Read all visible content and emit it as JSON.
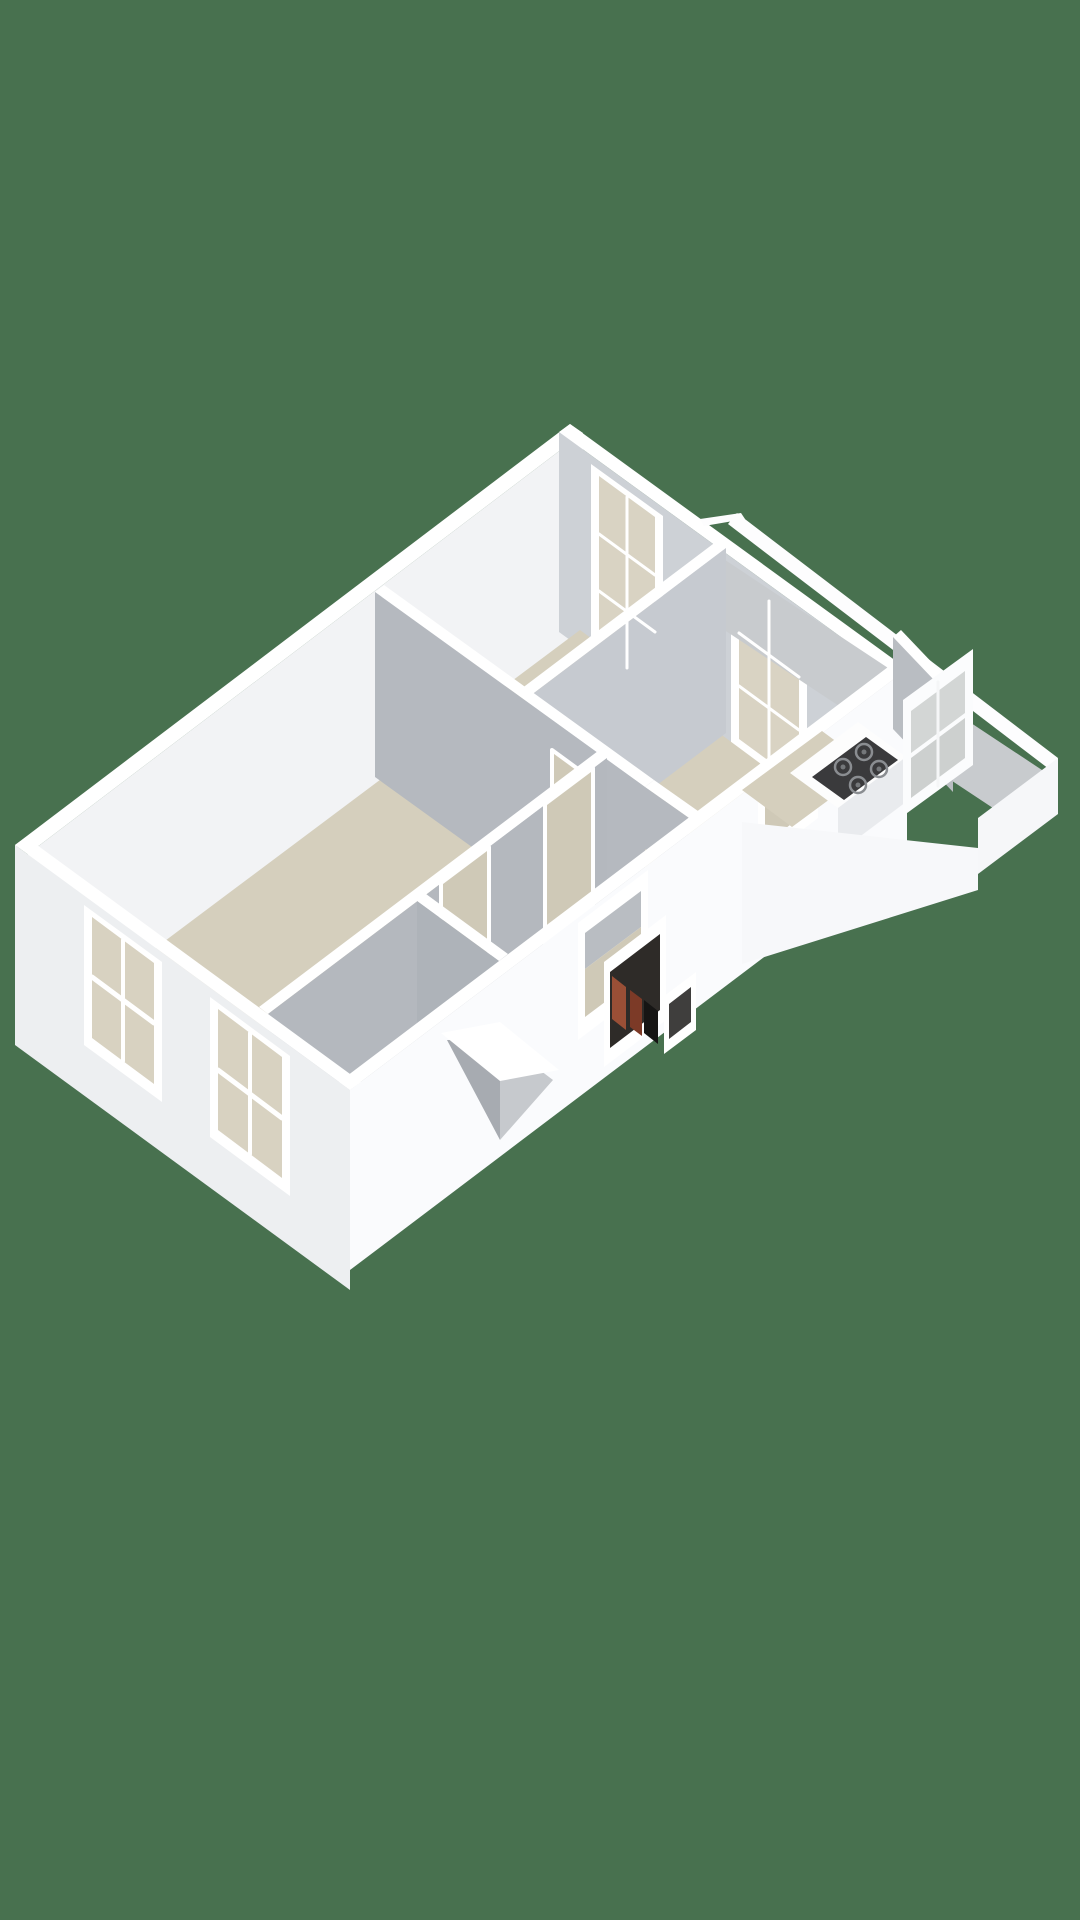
{
  "scene": {
    "kind": "3d-floor-plan-render",
    "view": "axonometric-top-down",
    "background": "#48714F",
    "palette": {
      "background_green": "#48714F",
      "wall_top_white": "#ffffff",
      "exterior_wall_light": "#fafbfd",
      "exterior_wall_shaded": "#edeff1",
      "interior_wall_gray": "#b5b9bf",
      "interior_wall_light_gray": "#cdd1d6",
      "floor_beige": "#d5cfbd",
      "window_glass": "#d9d3c3",
      "cooktop_dark": "#3a3a3c",
      "closet_dark": "#2e2b28",
      "closet_red_brown": "#9a4f36"
    },
    "shapes": [
      {
        "name": "nw-wall-top-band",
        "fill": "#ffffff",
        "points": "15,845 570,424 583,433 28,854"
      },
      {
        "name": "nw-wall-inner-face",
        "fill": "#f2f3f5",
        "points": "28,854 583,433 583,633 28,1054"
      },
      {
        "name": "ne-wall-top-band",
        "fill": "#ffffff",
        "points": "570,424 907,669 896,677 559,432"
      },
      {
        "name": "ne-wall-inner-face",
        "fill": "#cdd1d6",
        "points": "559,432 896,677 896,877 559,632"
      },
      {
        "name": "bedroom-window-a-frame",
        "fill": "#ffffff",
        "points": "591,464 663,516 663,706 591,654"
      },
      {
        "name": "bedroom-window-a-glass",
        "fill": "#d9d3c3",
        "points": "599,476 655,517 655,688 599,647"
      },
      {
        "name": "bedroom-window-b-frame",
        "fill": "#ffffff",
        "points": "731,566 807,621 807,801 731,746"
      },
      {
        "name": "bedroom-window-b-glass",
        "fill": "#d9d3c3",
        "points": "739,578 799,622 799,783 739,739"
      },
      {
        "name": "floor-plate",
        "fill": "#d5cfbd",
        "points": "30,1042 580,630 888,858 348,1262"
      },
      {
        "name": "walkway-outer-band",
        "fill": "#fdfdfe",
        "points": "737,513 1058,758 1049,769 728,524"
      },
      {
        "name": "walkway-notch-band",
        "fill": "#fdfdfe",
        "points": "700,519 741,513 745,519 704,526"
      },
      {
        "name": "walkway-floor",
        "fill": "#c8cbce",
        "points": "710,550 1045,772 1002,814 667,592"
      },
      {
        "name": "bay-end-face",
        "fill": "#f6f7f9",
        "points": "1058,758 978,818 978,874 1058,814"
      },
      {
        "name": "partition-w2-top-band",
        "fill": "#ffffff",
        "points": "517,692 717,541 726,548 526,699"
      },
      {
        "name": "partition-w2-face",
        "fill": "#c6cad0",
        "points": "526,699 726,548 726,733 526,884"
      },
      {
        "name": "partition-w1-top-band",
        "fill": "#ffffff",
        "points": "375,592 645,787 654,780 384,585"
      },
      {
        "name": "partition-w1-face",
        "fill": "#b5b9bf",
        "points": "375,592 645,787 645,972 375,777"
      },
      {
        "name": "doorway-living-room",
        "fill": "#cfc9b7",
        "stroke": "#ffffff",
        "stroke_width": 4,
        "points": "552,750 604,788 604,928 552,890"
      },
      {
        "name": "partition-w5-top-band",
        "fill": "#ffffff",
        "points": "645,787 689,818 698,811 654,780"
      },
      {
        "name": "partition-w5-face",
        "fill": "#b5b9bf",
        "points": "645,787 689,818 689,880 645,849"
      },
      {
        "name": "hall-wall-top-band",
        "fill": "#ffffff",
        "points": "259,1007 598,751 607,758 268,1014"
      },
      {
        "name": "hall-wall-face",
        "fill": "#b4b8be",
        "points": "268,1014 607,758 607,898 268,1154"
      },
      {
        "name": "hall-doorway-1",
        "fill": "#cfc9b7",
        "stroke": "#ffffff",
        "stroke_width": 4,
        "points": "441,883 489,847 489,987 441,1023"
      },
      {
        "name": "hall-doorway-2",
        "fill": "#cfc9b7",
        "stroke": "#ffffff",
        "stroke_width": 4,
        "points": "545,804 593,768 593,908 545,944"
      },
      {
        "name": "bedroom2-wall-top-band",
        "fill": "#ffffff",
        "points": "417,901 499,961 508,954 426,894"
      },
      {
        "name": "bedroom2-wall-face",
        "fill": "#aeb3b9",
        "points": "417,901 499,961 499,1101 417,1041"
      },
      {
        "name": "se-facade",
        "fill": "#fafbfd",
        "points": "350,1090 907,669 907,849 350,1270"
      },
      {
        "name": "se-facade-top-band",
        "fill": "#ffffff",
        "points": "339,1082 896,661 907,669 350,1090"
      },
      {
        "name": "facade-opening-1-frame",
        "fill": "#ffffff",
        "points": "578,923 648,870 648,987 578,1040"
      },
      {
        "name": "facade-opening-1-wall-sliver",
        "fill": "#b9bdc2",
        "points": "585,933 641,891 641,927 585,969"
      },
      {
        "name": "facade-opening-1-interior",
        "fill": "#cfc9b7",
        "points": "585,969 641,927 641,975 585,1017"
      },
      {
        "name": "utility-closet-frame",
        "fill": "#ffffff",
        "points": "604,962 666,915 666,1020 604,1067"
      },
      {
        "name": "utility-closet-dark-interior",
        "fill": "#2e2b28",
        "points": "610,972 660,934 660,1010 610,1048"
      },
      {
        "name": "utility-closet-red-unit-1",
        "fill": "#9a4f36",
        "points": "612,976 626,987 626,1030 612,1019"
      },
      {
        "name": "utility-closet-red-unit-2",
        "fill": "#7c3a27",
        "points": "630,990 642,999 642,1036 630,1027"
      },
      {
        "name": "utility-closet-black-unit",
        "fill": "#161514",
        "points": "644,1000 658,1011 658,1044 644,1033"
      },
      {
        "name": "facade-slot-frame",
        "fill": "#ffffff",
        "points": "664,996 696,972 696,1030 664,1054"
      },
      {
        "name": "facade-slot-dark",
        "fill": "#3f3e3d",
        "points": "669,1004 691,987 691,1022 669,1039"
      },
      {
        "name": "kitchen-passthrough-frame",
        "fill": "#ffffff",
        "points": "758,787 818,741 818,818 758,864"
      },
      {
        "name": "kitchen-passthrough-interior",
        "fill": "#cfc9b7",
        "points": "765,796 811,761 811,809 765,844"
      },
      {
        "name": "kitchen-floor-patch",
        "fill": "#d5cfbd",
        "points": "742,790 822,731 872,768 792,827"
      },
      {
        "name": "kitchen-counter-top",
        "fill": "#fdfdfd",
        "points": "790,773 858,722 906,757 838,808"
      },
      {
        "name": "kitchen-counter-front",
        "fill": "#e9ebee",
        "points": "838,808 906,757 906,802 838,853"
      },
      {
        "name": "cooktop",
        "fill": "#3a3a3c",
        "points": "812,777 866,737 898,760 844,800"
      },
      {
        "name": "bay-partition-top-band",
        "fill": "#ffffff",
        "points": "893,637 953,700 961,693 901,630"
      },
      {
        "name": "bay-partition-face",
        "fill": "#b9bdc2",
        "points": "893,637 953,700 953,792 893,729"
      },
      {
        "name": "balcony-door-frame",
        "fill": "#fbfcfd",
        "points": "903,700 973,649 973,765 903,816"
      },
      {
        "name": "balcony-door-glass-upper",
        "fill": "#d3d6d5",
        "points": "911,711 965,671 965,713 911,753"
      },
      {
        "name": "balcony-door-glass-lower",
        "fill": "#cdd0cf",
        "points": "911,758 965,718 965,758 911,798"
      },
      {
        "name": "bay-front-face",
        "fill": "#f7f8fa",
        "points": "742,822 978,848 978,890 742,964"
      },
      {
        "name": "sw-facade",
        "fill": "#edeff1",
        "points": "15,845 350,1090 350,1290 15,1045"
      },
      {
        "name": "sw-facade-top-band",
        "fill": "#ffffff",
        "points": "15,845 350,1090 361,1082 26,837"
      },
      {
        "name": "facade-window-1-frame",
        "fill": "#ffffff",
        "points": "84,905 162,962 162,1102 84,1045"
      },
      {
        "name": "facade-window-1-glass",
        "fill": "#d8d2c1",
        "points": "92,917 154,963 154,1084 92,1038"
      },
      {
        "name": "facade-window-2-frame",
        "fill": "#ffffff",
        "points": "210,997 290,1056 290,1196 210,1137"
      },
      {
        "name": "facade-window-2-glass",
        "fill": "#d8d2c1",
        "points": "218,1009 282,1057 282,1178 218,1130"
      },
      {
        "name": "entry-bay-left-face",
        "fill": "#a7abb1",
        "points": "447,1040 500,1140 500,1040"
      },
      {
        "name": "entry-bay-right-face",
        "fill": "#c6c9cd",
        "points": "500,1040 500,1140 553,1080"
      },
      {
        "name": "entry-bay-top-band",
        "fill": "#ffffff",
        "points": "441,1033 500,1022 559,1070 500,1081"
      }
    ],
    "circles": [
      {
        "name": "burner-ring-1",
        "cx": 843,
        "cy": 767,
        "r": 8,
        "fill": "none",
        "stroke": "#8a8d91",
        "stroke_width": 2.5
      },
      {
        "name": "burner-ring-2",
        "cx": 864,
        "cy": 752,
        "r": 8,
        "fill": "none",
        "stroke": "#8a8d91",
        "stroke_width": 2.5
      },
      {
        "name": "burner-ring-3",
        "cx": 858,
        "cy": 785,
        "r": 8,
        "fill": "none",
        "stroke": "#8a8d91",
        "stroke_width": 2.5
      },
      {
        "name": "burner-ring-4",
        "cx": 879,
        "cy": 769,
        "r": 8,
        "fill": "none",
        "stroke": "#8a8d91",
        "stroke_width": 2.5
      },
      {
        "name": "burner-center-1",
        "cx": 843,
        "cy": 767,
        "r": 2.5,
        "fill": "#74777a",
        "stroke": "none",
        "stroke_width": 0
      },
      {
        "name": "burner-center-2",
        "cx": 864,
        "cy": 752,
        "r": 2.5,
        "fill": "#74777a",
        "stroke": "none",
        "stroke_width": 0
      },
      {
        "name": "burner-center-3",
        "cx": 858,
        "cy": 785,
        "r": 2.5,
        "fill": "#74777a",
        "stroke": "none",
        "stroke_width": 0
      },
      {
        "name": "burner-center-4",
        "cx": 879,
        "cy": 769,
        "r": 2.5,
        "fill": "#74777a",
        "stroke": "none",
        "stroke_width": 0
      }
    ],
    "lines": [
      {
        "name": "window-a-muntin-vertical",
        "x1": 627,
        "y1": 497,
        "x2": 627,
        "y2": 668,
        "stroke": "#ffffff",
        "w": 3
      },
      {
        "name": "window-a-muntin-horizontal-1",
        "x1": 599,
        "y1": 534,
        "x2": 655,
        "y2": 575,
        "stroke": "#ffffff",
        "w": 3
      },
      {
        "name": "window-a-muntin-horizontal-2",
        "x1": 599,
        "y1": 591,
        "x2": 655,
        "y2": 632,
        "stroke": "#ffffff",
        "w": 3
      },
      {
        "name": "window-b-muntin-vertical",
        "x1": 769,
        "y1": 601,
        "x2": 769,
        "y2": 762,
        "stroke": "#ffffff",
        "w": 3
      },
      {
        "name": "window-b-muntin-horizontal-1",
        "x1": 739,
        "y1": 633,
        "x2": 799,
        "y2": 677,
        "stroke": "#ffffff",
        "w": 3
      },
      {
        "name": "window-b-muntin-horizontal-2",
        "x1": 739,
        "y1": 686,
        "x2": 799,
        "y2": 730,
        "stroke": "#ffffff",
        "w": 3
      },
      {
        "name": "facade-window-1-sash-vertical",
        "x1": 123,
        "y1": 940,
        "x2": 123,
        "y2": 1061,
        "stroke": "#ffffff",
        "w": 4
      },
      {
        "name": "facade-window-1-sash-rail",
        "x1": 92,
        "y1": 977,
        "x2": 154,
        "y2": 1023,
        "stroke": "#ffffff",
        "w": 5
      },
      {
        "name": "facade-window-2-sash-vertical",
        "x1": 250,
        "y1": 1033,
        "x2": 250,
        "y2": 1154,
        "stroke": "#ffffff",
        "w": 4
      },
      {
        "name": "facade-window-2-sash-rail",
        "x1": 218,
        "y1": 1070,
        "x2": 282,
        "y2": 1118,
        "stroke": "#ffffff",
        "w": 5
      },
      {
        "name": "balcony-door-mullion",
        "x1": 938,
        "y1": 682,
        "x2": 938,
        "y2": 786,
        "stroke": "#f5f6f7",
        "w": 3
      }
    ]
  }
}
